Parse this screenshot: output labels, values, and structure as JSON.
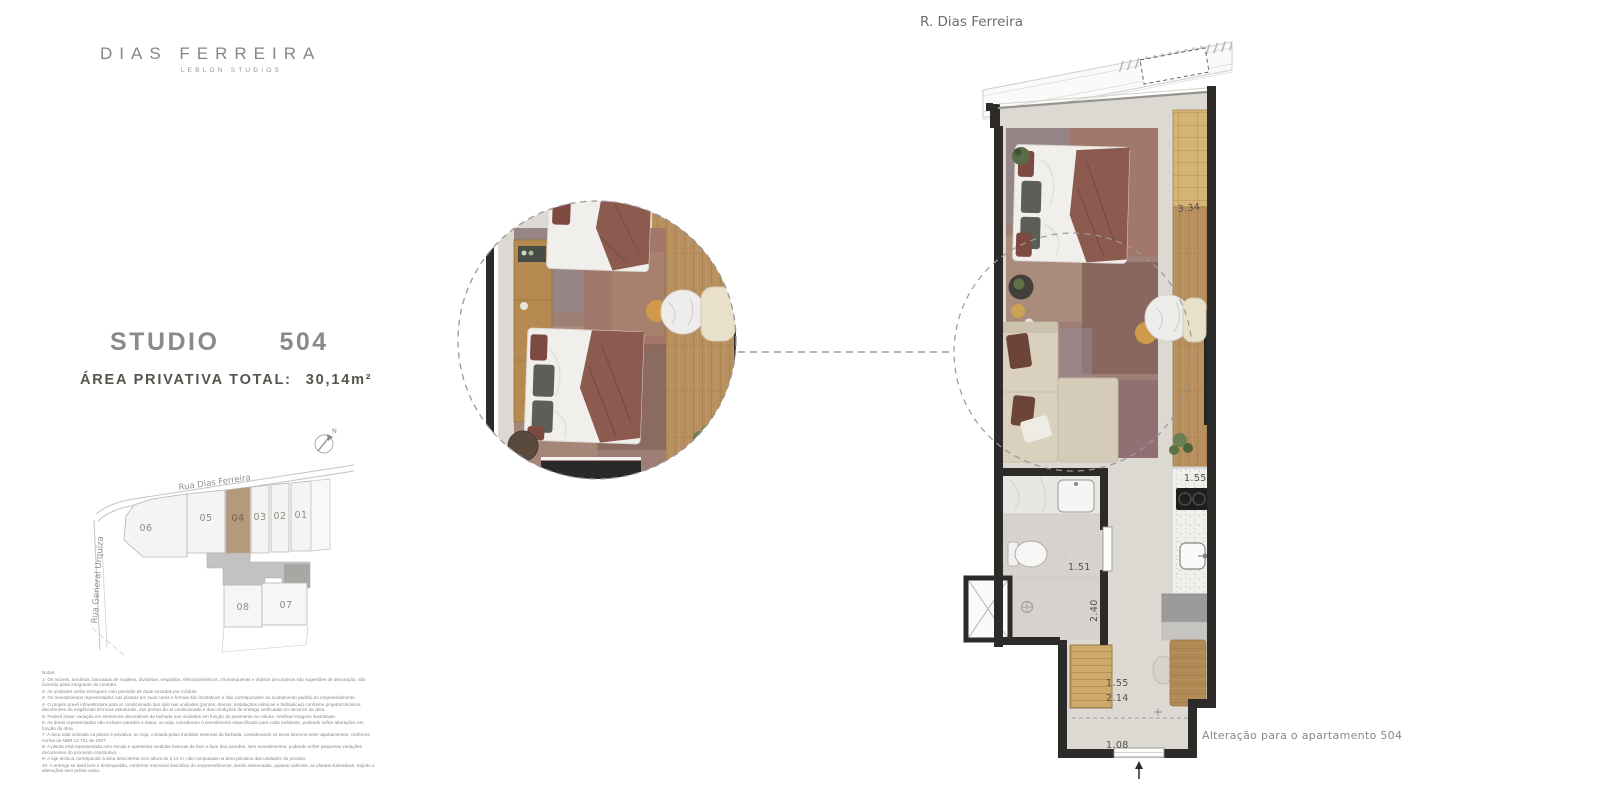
{
  "brand": {
    "name": "DIAS FERREIRA",
    "tagline": "LEBLON STUDIOS"
  },
  "plan_header": {
    "street": "R. Dias Ferreira"
  },
  "unit": {
    "type": "STUDIO",
    "number": "504",
    "area_label": "ÁREA PRIVATIVA TOTAL:",
    "area_value": "30,14m²"
  },
  "site_map": {
    "street_top": "Rua Dias Ferreira",
    "street_left": "Rua General Urquiza",
    "compass": "N",
    "units_top": [
      "06",
      "05",
      "04",
      "03",
      "02",
      "01"
    ],
    "units_bottom": [
      "08",
      "07"
    ],
    "highlighted_unit": "04",
    "highlight_color": "#b6997a"
  },
  "floor_plan": {
    "dimensions": {
      "closet": "3.34",
      "kitchen": "1.55",
      "bath_width": "1.51",
      "bath_depth": "2.40",
      "hall_width": "1.55",
      "hall_depth": "2.14",
      "entry_door": "1.08"
    },
    "annotation": "Alteração para o apartamento 504",
    "colors": {
      "wall": "#2d2b29",
      "floor": "#dcd8d2",
      "wood": "#b8905f",
      "rug": "#9e7f75",
      "accent": "#8d5a50",
      "sofa": "#d9d0bd"
    }
  },
  "notes": {
    "title": "Notas:",
    "lines": [
      "1- Os móveis, armários, bancadas de madeira, divisórias, respaldos, eletrodomésticos, churrasqueiras e objetos decorativos são sugestões de decoração, não fazendo parte integrante do contrato.",
      "2- As unidades serão entregues com previsão de duas tomadas por módulo.",
      "3- Os revestimentos representados nas plantas em suas cores e formas são ilustrativos e não correspondem ao acabamento padrão do empreendimento.",
      "4- O projeto prevê infraestrutura para ar condicionado tipo split nas unidades (pontos, drenos, instalações elétricas e hidráulicas) conforme projetos técnicos, decorrentes de exigências técnicas estruturais, dos pontos de ar condicionado e das condições de entrega verificadas no decorrer da obra.",
      "5- Poderá haver variação em elementos decorativos da fachada nas unidades em função do pavimento ou coluna. Verificar imagens ilustrativas.",
      "6- As áreas representadas não incluem paredes e dutos, ou seja, consideram o revestimento especificado para cada ambiente, podendo sofrer alterações em função da obra.",
      "7- A área total indicada na planta é privativa, ou seja, contada pelas medidas externas da fachada, considerando os eixos internos entre apartamentos, conforme norma da NBR 12.721 de 2007.",
      "8- A planta está representada sem escala e apresenta medidas internas de face a face das paredes, sem revestimentos, podendo sofrer pequenas variações decorrentes do processo construtivo.",
      "9- A laje técnica corresponde à área descoberta com altura de 2,10 m, não computada na área privativa das unidades do produto.",
      "10- A entrega se dará livre e desimpedida, conforme memorial descritivo do empreendimento, sendo observadas, quando cabíveis, as plantas ilustrativas. Sujeito a alterações sem prévio aviso."
    ]
  }
}
